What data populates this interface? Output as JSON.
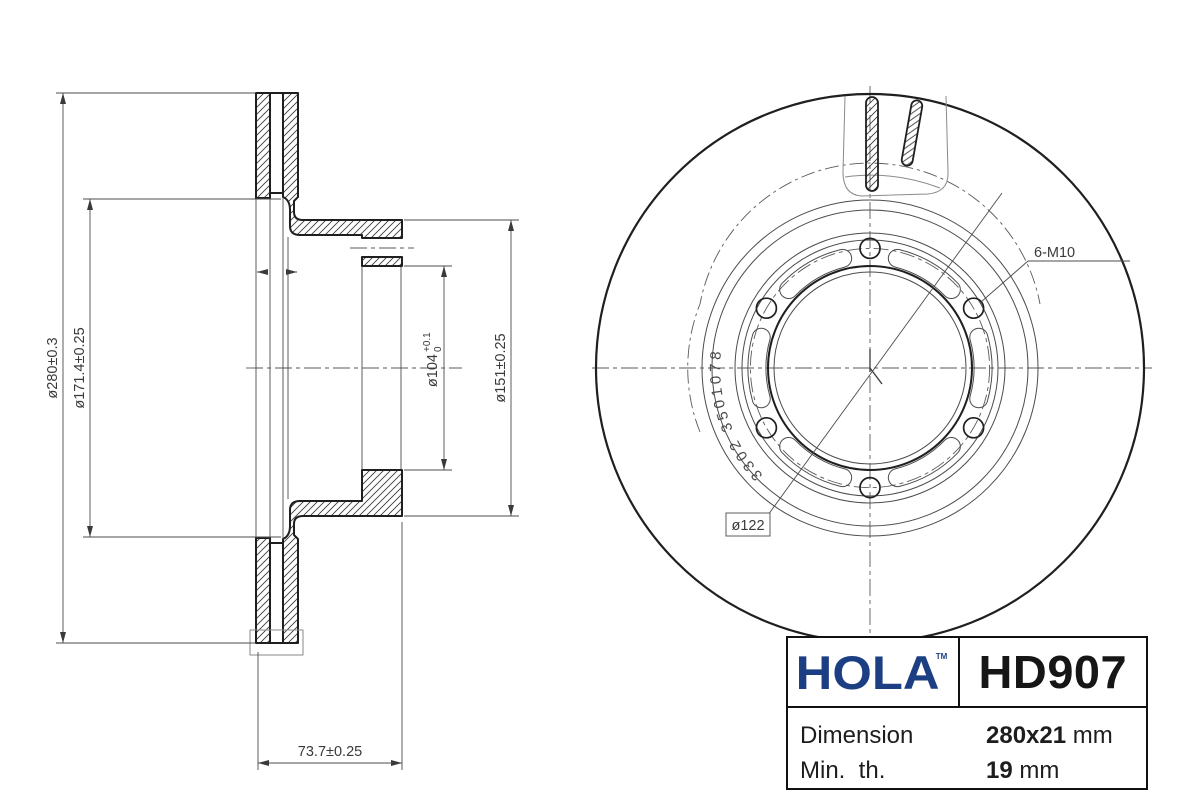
{
  "sheet": {
    "background": "#ffffff",
    "line_color": "#2b2b2b",
    "accent_color": "#1c3e82"
  },
  "section_view": {
    "dim_outer": "ø280±0.3",
    "dim_friction": "ø171.4±0.25",
    "dim_bore": "ø104",
    "dim_bore_tol_up": "+0.1",
    "dim_bore_tol_dn": "0",
    "dim_flange": "ø151±0.25",
    "dim_width": "73.7±0.25"
  },
  "front_view": {
    "bolt_label": "6-M10",
    "pcd_label": "ø122",
    "cast_marking": "3302 3501078"
  },
  "title_block": {
    "brand": "HOLA",
    "brand_tm": "TM",
    "brand_color": "#1c3e82",
    "part_number": "HD907",
    "rows": [
      {
        "label": "Dimension",
        "value": "280x21",
        "unit": "mm"
      },
      {
        "label": "Min.  th.",
        "value": "19",
        "unit": "mm"
      }
    ]
  }
}
